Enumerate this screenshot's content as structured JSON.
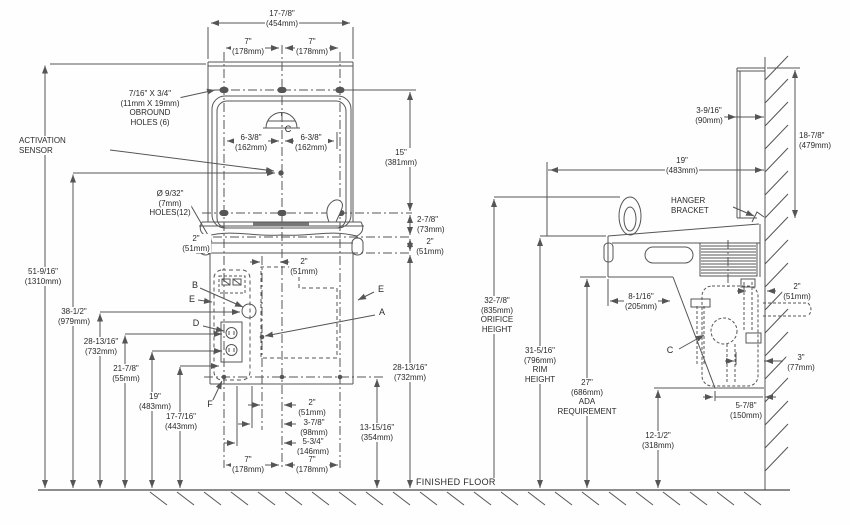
{
  "meta": {
    "line_color": "#555555",
    "text_color": "#2a2a2a",
    "bg": "#fefefe"
  },
  "f": {
    "w": {
      "a": "17-7/8\"",
      "b": "(454mm)"
    },
    "s7l": {
      "a": "7\"",
      "b": "(178mm)"
    },
    "s7r": {
      "a": "7\"",
      "b": "(178mm)"
    },
    "obround": {
      "a": "7/16\" X 3/4\"",
      "b": "(11mm X 19mm)",
      "c": "OBROUND",
      "d": "HOLES (6)"
    },
    "sensor": {
      "a": "ACTIVATION",
      "b": "SENSOR"
    },
    "d638l": {
      "a": "6-3/8\"",
      "b": "(162mm)"
    },
    "d638r": {
      "a": "6-3/8\"",
      "b": "(162mm)"
    },
    "d15": {
      "a": "15\"",
      "b": "(381mm)"
    },
    "holes": {
      "a": "Ø 9/32\"",
      "b": "(7mm)",
      "c": "HOLES(12)"
    },
    "d278": {
      "a": "2-7/8\"",
      "b": "(73mm)"
    },
    "d2l": {
      "a": "2\"",
      "b": "(51mm)"
    },
    "d2r": {
      "a": "2\"",
      "b": "(51mm)"
    },
    "d2c": {
      "a": "2\"",
      "b": "(51mm)"
    },
    "cb": "B",
    "cel": "E",
    "cd": "D",
    "cf": "F",
    "cer": "E",
    "ca": "A",
    "cc": "C",
    "d5196": {
      "a": "51-9/16\"",
      "b": "(1310mm)"
    },
    "d3812": {
      "a": "38-1/2\"",
      "b": "(979mm)"
    },
    "d28l": {
      "a": "28-13/16\"",
      "b": "(732mm)"
    },
    "d2178": {
      "a": "21-7/8\"",
      "b": "(55mm)"
    },
    "d19": {
      "a": "19\"",
      "b": "(483mm)"
    },
    "d17716": {
      "a": "17-7/16\"",
      "b": "(443mm)"
    },
    "d28r": {
      "a": "28-13/16\"",
      "b": "(732mm)"
    },
    "d13": {
      "a": "13-15/16\"",
      "b": "(354mm)"
    },
    "db2": {
      "a": "2\"",
      "b": "(51mm)"
    },
    "db378": {
      "a": "3-7/8\"",
      "b": "(98mm)"
    },
    "db534": {
      "a": "5-3/4\"",
      "b": "(146mm)"
    },
    "db7l": {
      "a": "7\"",
      "b": "(178mm)"
    },
    "db7r": {
      "a": "7\"",
      "b": "(178mm)"
    },
    "floor": "FINISHED FLOOR"
  },
  "s": {
    "d3916": {
      "a": "3-9/16\"",
      "b": "(90mm)"
    },
    "d1878": {
      "a": "18-7/8\"",
      "b": "(479mm)"
    },
    "d19": {
      "a": "19\"",
      "b": "(483mm)"
    },
    "hanger": {
      "a": "HANGER",
      "b": "BRACKET"
    },
    "d8116": {
      "a": "8-1/16\"",
      "b": "(205mm)"
    },
    "d2": {
      "a": "2\"",
      "b": "(51mm)"
    },
    "orifice": {
      "a": "32-7/8\"",
      "b": "(835mm)",
      "c": "ORIFICE",
      "d": "HEIGHT"
    },
    "rim": {
      "a": "31-5/16\"",
      "b": "(796mm)",
      "c": "RIM",
      "d": "HEIGHT"
    },
    "ada": {
      "a": "27\"",
      "b": "(686mm)",
      "c": "ADA",
      "d": "REQUIREMENT"
    },
    "cc": "C",
    "d3": {
      "a": "3\"",
      "b": "(77mm)"
    },
    "d578": {
      "a": "5-7/8\"",
      "b": "(150mm)"
    },
    "d1212": {
      "a": "12-1/2\"",
      "b": "(318mm)"
    }
  }
}
